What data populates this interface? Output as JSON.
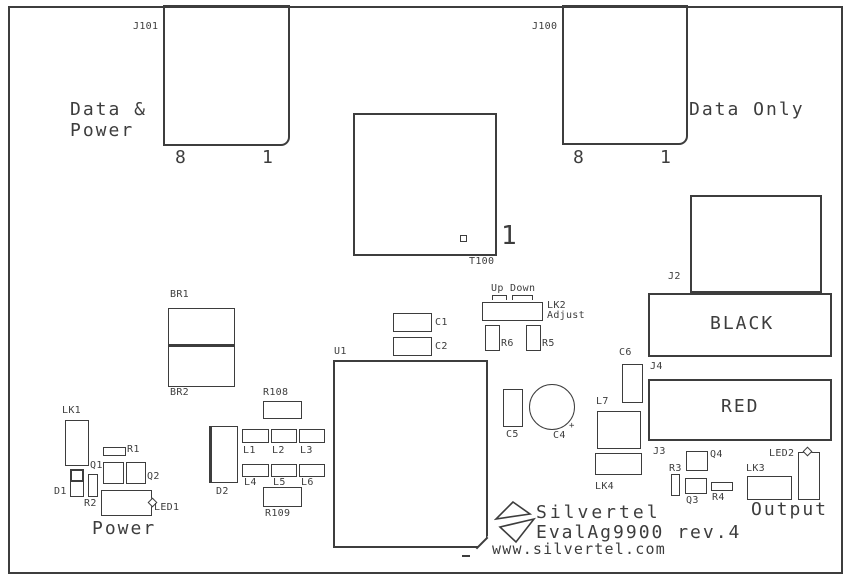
{
  "colors": {
    "line": "#3d3d3d",
    "text": "#3d3d3d",
    "background": "#ffffff"
  },
  "branding": {
    "company": "Silvertel",
    "product": "EvalAg9900 rev.4",
    "website": "www.silvertel.com"
  },
  "boxes": [
    {
      "name": "drawing-frame",
      "x": 8,
      "y": 6,
      "w": 835,
      "h": 568,
      "cls": "b2"
    },
    {
      "name": "j101-connector",
      "x": 163,
      "y": 5,
      "w": 127,
      "h": 141,
      "cls": "b2 rbr"
    },
    {
      "name": "j100-connector",
      "x": 562,
      "y": 5,
      "w": 126,
      "h": 140,
      "cls": "b2 rbr"
    },
    {
      "name": "t100-transformer",
      "x": 353,
      "y": 113,
      "w": 144,
      "h": 143,
      "cls": "b2"
    },
    {
      "name": "t100-pin1-marker",
      "x": 460,
      "y": 235,
      "w": 7,
      "h": 7,
      "cls": ""
    },
    {
      "name": "j2-connector",
      "x": 690,
      "y": 195,
      "w": 132,
      "h": 98,
      "cls": "b2"
    },
    {
      "name": "black-terminal",
      "x": 648,
      "y": 293,
      "w": 184,
      "h": 64,
      "cls": "b2"
    },
    {
      "name": "red-terminal",
      "x": 648,
      "y": 379,
      "w": 184,
      "h": 62,
      "cls": "b2"
    },
    {
      "name": "br1-bridge",
      "x": 168,
      "y": 308,
      "w": 67,
      "h": 39,
      "cls": "bb2"
    },
    {
      "name": "br2-bridge",
      "x": 168,
      "y": 346,
      "w": 67,
      "h": 41,
      "cls": ""
    },
    {
      "name": "r108-resistor",
      "x": 263,
      "y": 401,
      "w": 39,
      "h": 18,
      "cls": ""
    },
    {
      "name": "c1-capacitor",
      "x": 393,
      "y": 313,
      "w": 39,
      "h": 19,
      "cls": ""
    },
    {
      "name": "c2-capacitor",
      "x": 393,
      "y": 337,
      "w": 39,
      "h": 19,
      "cls": ""
    },
    {
      "name": "up-jumper-bracket",
      "x": 492,
      "y": 295,
      "w": 15,
      "h": 5,
      "cls": "bracket"
    },
    {
      "name": "down-jumper-bracket",
      "x": 512,
      "y": 295,
      "w": 21,
      "h": 5,
      "cls": "bracket"
    },
    {
      "name": "lk2-jumper",
      "x": 482,
      "y": 302,
      "w": 61,
      "h": 19,
      "cls": ""
    },
    {
      "name": "r6-resistor",
      "x": 485,
      "y": 325,
      "w": 15,
      "h": 26,
      "cls": ""
    },
    {
      "name": "r5-resistor",
      "x": 526,
      "y": 325,
      "w": 15,
      "h": 26,
      "cls": ""
    },
    {
      "name": "u1-ic",
      "x": 333,
      "y": 360,
      "w": 155,
      "h": 188,
      "cls": "b2 chamfer"
    },
    {
      "name": "u1-chamfer-edge",
      "x": 474,
      "y": 542,
      "w": 16,
      "h": 0,
      "cls": "diagline"
    },
    {
      "name": "u1-pin-mark",
      "x": 462,
      "y": 555,
      "w": 8,
      "h": 2,
      "cls": "fill"
    },
    {
      "name": "c5-capacitor",
      "x": 503,
      "y": 389,
      "w": 20,
      "h": 38,
      "cls": ""
    },
    {
      "name": "c4-capacitor",
      "x": 529,
      "y": 384,
      "w": 46,
      "h": 46,
      "cls": "circle"
    },
    {
      "name": "c6-capacitor",
      "x": 622,
      "y": 364,
      "w": 21,
      "h": 39,
      "cls": ""
    },
    {
      "name": "l7-inductor",
      "x": 597,
      "y": 411,
      "w": 44,
      "h": 38,
      "cls": ""
    },
    {
      "name": "lk4-jumper",
      "x": 595,
      "y": 453,
      "w": 47,
      "h": 22,
      "cls": ""
    },
    {
      "name": "lk1-jumper",
      "x": 65,
      "y": 420,
      "w": 24,
      "h": 46,
      "cls": ""
    },
    {
      "name": "r1-resistor",
      "x": 103,
      "y": 447,
      "w": 23,
      "h": 9,
      "cls": ""
    },
    {
      "name": "q1-transistor",
      "x": 103,
      "y": 462,
      "w": 21,
      "h": 22,
      "cls": ""
    },
    {
      "name": "q2-transistor",
      "x": 126,
      "y": 462,
      "w": 20,
      "h": 22,
      "cls": ""
    },
    {
      "name": "d1-diode",
      "x": 70,
      "y": 469,
      "w": 14,
      "h": 28,
      "cls": ""
    },
    {
      "name": "d1-cathode-band",
      "x": 70,
      "y": 469,
      "w": 14,
      "h": 13,
      "cls": "b2"
    },
    {
      "name": "r2-resistor",
      "x": 88,
      "y": 474,
      "w": 10,
      "h": 23,
      "cls": ""
    },
    {
      "name": "led1",
      "x": 101,
      "y": 490,
      "w": 51,
      "h": 26,
      "cls": ""
    },
    {
      "name": "led1-notch",
      "x": 149,
      "y": 499,
      "w": 7,
      "h": 7,
      "cls": "notch"
    },
    {
      "name": "d2-diode",
      "x": 209,
      "y": 426,
      "w": 29,
      "h": 57,
      "cls": "bl3"
    },
    {
      "name": "l1-inductor",
      "x": 242,
      "y": 429,
      "w": 27,
      "h": 14,
      "cls": ""
    },
    {
      "name": "l2-inductor",
      "x": 271,
      "y": 429,
      "w": 26,
      "h": 14,
      "cls": ""
    },
    {
      "name": "l3-inductor",
      "x": 299,
      "y": 429,
      "w": 26,
      "h": 14,
      "cls": ""
    },
    {
      "name": "l4-inductor",
      "x": 242,
      "y": 464,
      "w": 27,
      "h": 13,
      "cls": ""
    },
    {
      "name": "l5-inductor",
      "x": 271,
      "y": 464,
      "w": 26,
      "h": 13,
      "cls": ""
    },
    {
      "name": "l6-inductor",
      "x": 299,
      "y": 464,
      "w": 26,
      "h": 13,
      "cls": ""
    },
    {
      "name": "r109-resistor",
      "x": 263,
      "y": 487,
      "w": 39,
      "h": 20,
      "cls": ""
    },
    {
      "name": "q4-transistor",
      "x": 686,
      "y": 451,
      "w": 22,
      "h": 20,
      "cls": ""
    },
    {
      "name": "r3-resistor",
      "x": 671,
      "y": 474,
      "w": 9,
      "h": 22,
      "cls": ""
    },
    {
      "name": "q3-transistor",
      "x": 685,
      "y": 478,
      "w": 22,
      "h": 16,
      "cls": ""
    },
    {
      "name": "r4-resistor",
      "x": 711,
      "y": 482,
      "w": 22,
      "h": 9,
      "cls": ""
    },
    {
      "name": "lk3-jumper",
      "x": 747,
      "y": 476,
      "w": 45,
      "h": 24,
      "cls": ""
    },
    {
      "name": "led2",
      "x": 798,
      "y": 452,
      "w": 22,
      "h": 48,
      "cls": ""
    },
    {
      "name": "led2-notch",
      "x": 804,
      "y": 448,
      "w": 7,
      "h": 7,
      "cls": "notch"
    }
  ],
  "labels": [
    {
      "name": "j101-ref",
      "text": "J101",
      "x": 133,
      "y": 21,
      "cls": "sm"
    },
    {
      "name": "j100-ref",
      "text": "J100",
      "x": 532,
      "y": 21,
      "cls": "sm"
    },
    {
      "name": "data-power-caption-line1",
      "text": "Data &",
      "x": 70,
      "y": 100,
      "cls": "lg"
    },
    {
      "name": "data-power-caption-line2",
      "text": "Power",
      "x": 70,
      "y": 121,
      "cls": "lg"
    },
    {
      "name": "data-only-caption",
      "text": "Data Only",
      "x": 689,
      "y": 100,
      "cls": "lg"
    },
    {
      "name": "j101-pin8",
      "text": "8",
      "x": 175,
      "y": 148,
      "cls": "lg"
    },
    {
      "name": "j101-pin1",
      "text": "1",
      "x": 262,
      "y": 148,
      "cls": "lg"
    },
    {
      "name": "j100-pin8",
      "text": "8",
      "x": 573,
      "y": 148,
      "cls": "lg"
    },
    {
      "name": "j100-pin1",
      "text": "1",
      "x": 660,
      "y": 148,
      "cls": "lg"
    },
    {
      "name": "t100-pin1-num",
      "text": "1",
      "x": 501,
      "y": 222,
      "cls": "xl"
    },
    {
      "name": "t100-ref",
      "text": "T100",
      "x": 469,
      "y": 256,
      "cls": "sm"
    },
    {
      "name": "j2-ref",
      "text": "J2",
      "x": 668,
      "y": 271,
      "cls": "sm"
    },
    {
      "name": "black-caption",
      "text": "BLACK",
      "x": 710,
      "y": 314,
      "cls": "lg"
    },
    {
      "name": "j4-ref",
      "text": "J4",
      "x": 650,
      "y": 361,
      "cls": "sm"
    },
    {
      "name": "red-caption",
      "text": "RED",
      "x": 721,
      "y": 397,
      "cls": "lg"
    },
    {
      "name": "c6-ref",
      "text": "C6",
      "x": 619,
      "y": 347,
      "cls": "sm"
    },
    {
      "name": "br1-ref",
      "text": "BR1",
      "x": 170,
      "y": 289,
      "cls": "sm"
    },
    {
      "name": "br2-ref",
      "text": "BR2",
      "x": 170,
      "y": 387,
      "cls": "sm"
    },
    {
      "name": "u1-ref",
      "text": "U1",
      "x": 334,
      "y": 346,
      "cls": "sm"
    },
    {
      "name": "c1-ref",
      "text": "C1",
      "x": 435,
      "y": 317,
      "cls": "sm"
    },
    {
      "name": "c2-ref",
      "text": "C2",
      "x": 435,
      "y": 341,
      "cls": "sm"
    },
    {
      "name": "up-caption",
      "text": "Up",
      "x": 491,
      "y": 283,
      "cls": "sm"
    },
    {
      "name": "down-caption",
      "text": "Down",
      "x": 510,
      "y": 283,
      "cls": "sm"
    },
    {
      "name": "lk2-ref",
      "text": "LK2",
      "x": 547,
      "y": 300,
      "cls": "sm"
    },
    {
      "name": "lk2-adjust-caption",
      "text": "Adjust",
      "x": 547,
      "y": 310,
      "cls": "sm"
    },
    {
      "name": "r6-ref",
      "text": "R6",
      "x": 501,
      "y": 338,
      "cls": "sm"
    },
    {
      "name": "r5-ref",
      "text": "R5",
      "x": 542,
      "y": 338,
      "cls": "sm"
    },
    {
      "name": "c5-ref",
      "text": "C5",
      "x": 506,
      "y": 429,
      "cls": "sm"
    },
    {
      "name": "c4-ref",
      "text": "C4",
      "x": 553,
      "y": 430,
      "cls": "sm"
    },
    {
      "name": "c4-polarity-mark",
      "text": "+",
      "x": 569,
      "y": 422,
      "cls": "tiny"
    },
    {
      "name": "l7-ref",
      "text": "L7",
      "x": 596,
      "y": 396,
      "cls": "sm"
    },
    {
      "name": "lk4-ref",
      "text": "LK4",
      "x": 595,
      "y": 481,
      "cls": "sm"
    },
    {
      "name": "j3-ref",
      "text": "J3",
      "x": 653,
      "y": 446,
      "cls": "sm"
    },
    {
      "name": "q4-ref",
      "text": "Q4",
      "x": 710,
      "y": 449,
      "cls": "sm"
    },
    {
      "name": "r3-ref",
      "text": "R3",
      "x": 669,
      "y": 463,
      "cls": "sm"
    },
    {
      "name": "q3-ref",
      "text": "Q3",
      "x": 686,
      "y": 495,
      "cls": "sm"
    },
    {
      "name": "r4-ref",
      "text": "R4",
      "x": 712,
      "y": 492,
      "cls": "sm"
    },
    {
      "name": "lk3-ref",
      "text": "LK3",
      "x": 746,
      "y": 463,
      "cls": "sm"
    },
    {
      "name": "led2-ref",
      "text": "LED2",
      "x": 769,
      "y": 448,
      "cls": "sm"
    },
    {
      "name": "output-caption",
      "text": "Output",
      "x": 751,
      "y": 500,
      "cls": "lg"
    },
    {
      "name": "lk1-ref",
      "text": "LK1",
      "x": 62,
      "y": 405,
      "cls": "sm"
    },
    {
      "name": "r1-ref",
      "text": "R1",
      "x": 127,
      "y": 444,
      "cls": "sm"
    },
    {
      "name": "q1-ref",
      "text": "Q1",
      "x": 90,
      "y": 460,
      "cls": "sm"
    },
    {
      "name": "q2-ref",
      "text": "Q2",
      "x": 147,
      "y": 471,
      "cls": "sm"
    },
    {
      "name": "d1-ref",
      "text": "D1",
      "x": 54,
      "y": 486,
      "cls": "sm"
    },
    {
      "name": "r2-ref",
      "text": "R2",
      "x": 84,
      "y": 498,
      "cls": "sm"
    },
    {
      "name": "led1-ref",
      "text": "LED1",
      "x": 154,
      "y": 502,
      "cls": "sm"
    },
    {
      "name": "power-caption",
      "text": "Power",
      "x": 92,
      "y": 519,
      "cls": "lg"
    },
    {
      "name": "d2-ref",
      "text": "D2",
      "x": 216,
      "y": 486,
      "cls": "sm"
    },
    {
      "name": "l1-ref",
      "text": "L1",
      "x": 243,
      "y": 445,
      "cls": "sm"
    },
    {
      "name": "l2-ref",
      "text": "L2",
      "x": 272,
      "y": 445,
      "cls": "sm"
    },
    {
      "name": "l3-ref",
      "text": "L3",
      "x": 300,
      "y": 445,
      "cls": "sm"
    },
    {
      "name": "l4-ref",
      "text": "L4",
      "x": 244,
      "y": 477,
      "cls": "sm"
    },
    {
      "name": "l5-ref",
      "text": "L5",
      "x": 273,
      "y": 477,
      "cls": "sm"
    },
    {
      "name": "l6-ref",
      "text": "L6",
      "x": 301,
      "y": 477,
      "cls": "sm"
    },
    {
      "name": "r108-ref",
      "text": "R108",
      "x": 263,
      "y": 387,
      "cls": "sm"
    },
    {
      "name": "r109-ref",
      "text": "R109",
      "x": 265,
      "y": 508,
      "cls": "sm"
    }
  ]
}
